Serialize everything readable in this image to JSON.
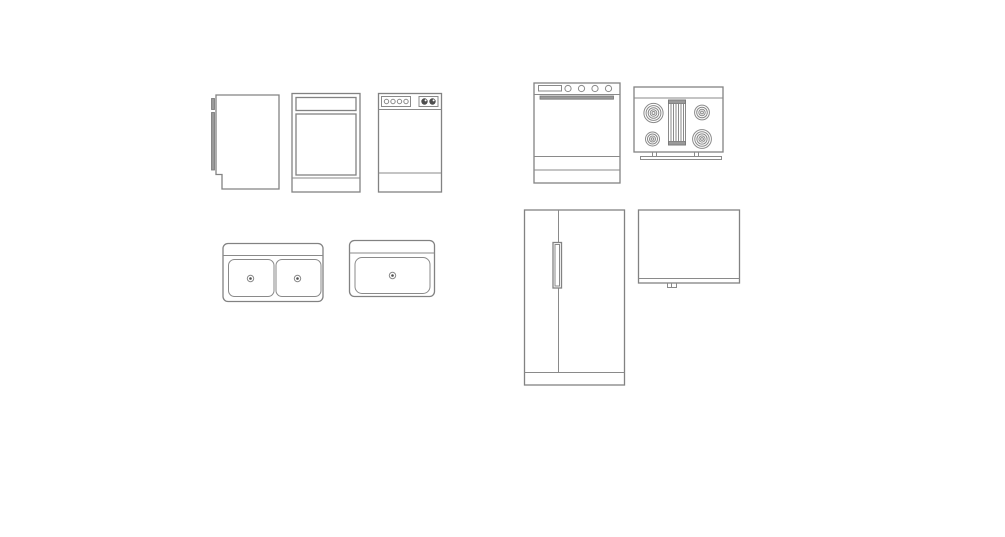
{
  "canvas": {
    "background": "#ffffff",
    "line_color": "#828282",
    "dark_fill": "#4f4f4f",
    "label": "CAD line drawings of kitchen appliance symbols on a blank white canvas"
  },
  "symbols": [
    {
      "id": "dishwasher-side",
      "label": "Dishwasher, side view with open door panel"
    },
    {
      "id": "dishwasher-front",
      "label": "Dishwasher, front view with door panels"
    },
    {
      "id": "dishwasher-front-controls",
      "label": "Dishwasher, front view with control buttons and two knobs"
    },
    {
      "id": "range-front",
      "label": "Range / oven, front view with display, four knobs, handle and drawers"
    },
    {
      "id": "range-top",
      "label": "Range, top view with four coil burners and center griddle"
    },
    {
      "id": "double-sink-top",
      "label": "Double-bowl kitchen sink, top view with two drains"
    },
    {
      "id": "single-sink-top",
      "label": "Single-bowl kitchen sink, top view with drain"
    },
    {
      "id": "refrigerator-front",
      "label": "Refrigerator, front view with two doors and vertical handle"
    },
    {
      "id": "refrigerator-side",
      "label": "Refrigerator, side view with base foot"
    }
  ]
}
